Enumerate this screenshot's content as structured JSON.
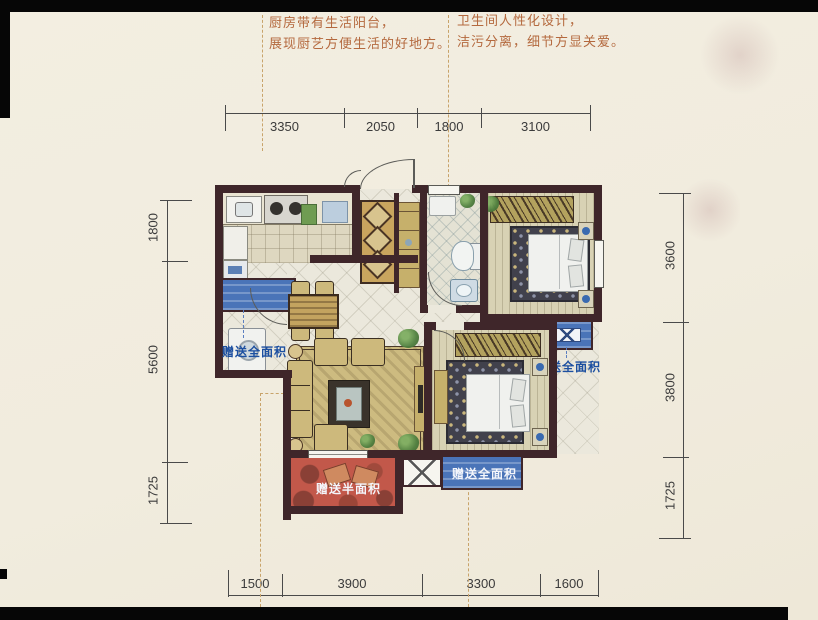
{
  "annotations": {
    "kitchen_note": [
      "厨房带有生活阳台，",
      "展现厨艺方便生活的好地方。"
    ],
    "bath_note": [
      "卫生间人性化设计，",
      "洁污分离，细节方显关爱。"
    ]
  },
  "dimensions": {
    "top": [
      "3350",
      "2050",
      "1800",
      "3100"
    ],
    "left": [
      "1800",
      "5600",
      "1725"
    ],
    "right": [
      "3600",
      "3800",
      "1725"
    ],
    "bottom": [
      "1500",
      "3900",
      "3300",
      "1600"
    ]
  },
  "labels": {
    "bonus_full_kitchen": "赠送全面积",
    "bonus_full_bedroom1": "赠送全面积",
    "bonus_full_bedroom2": "赠送全面积",
    "bonus_half_balcony": "赠送半面积"
  },
  "colors": {
    "wall": "#3f262a",
    "bay_blue": "#4a74b8",
    "label_blue": "#1c4fa0",
    "balcony_red": "#c2584a",
    "note_text": "#b4693e"
  }
}
